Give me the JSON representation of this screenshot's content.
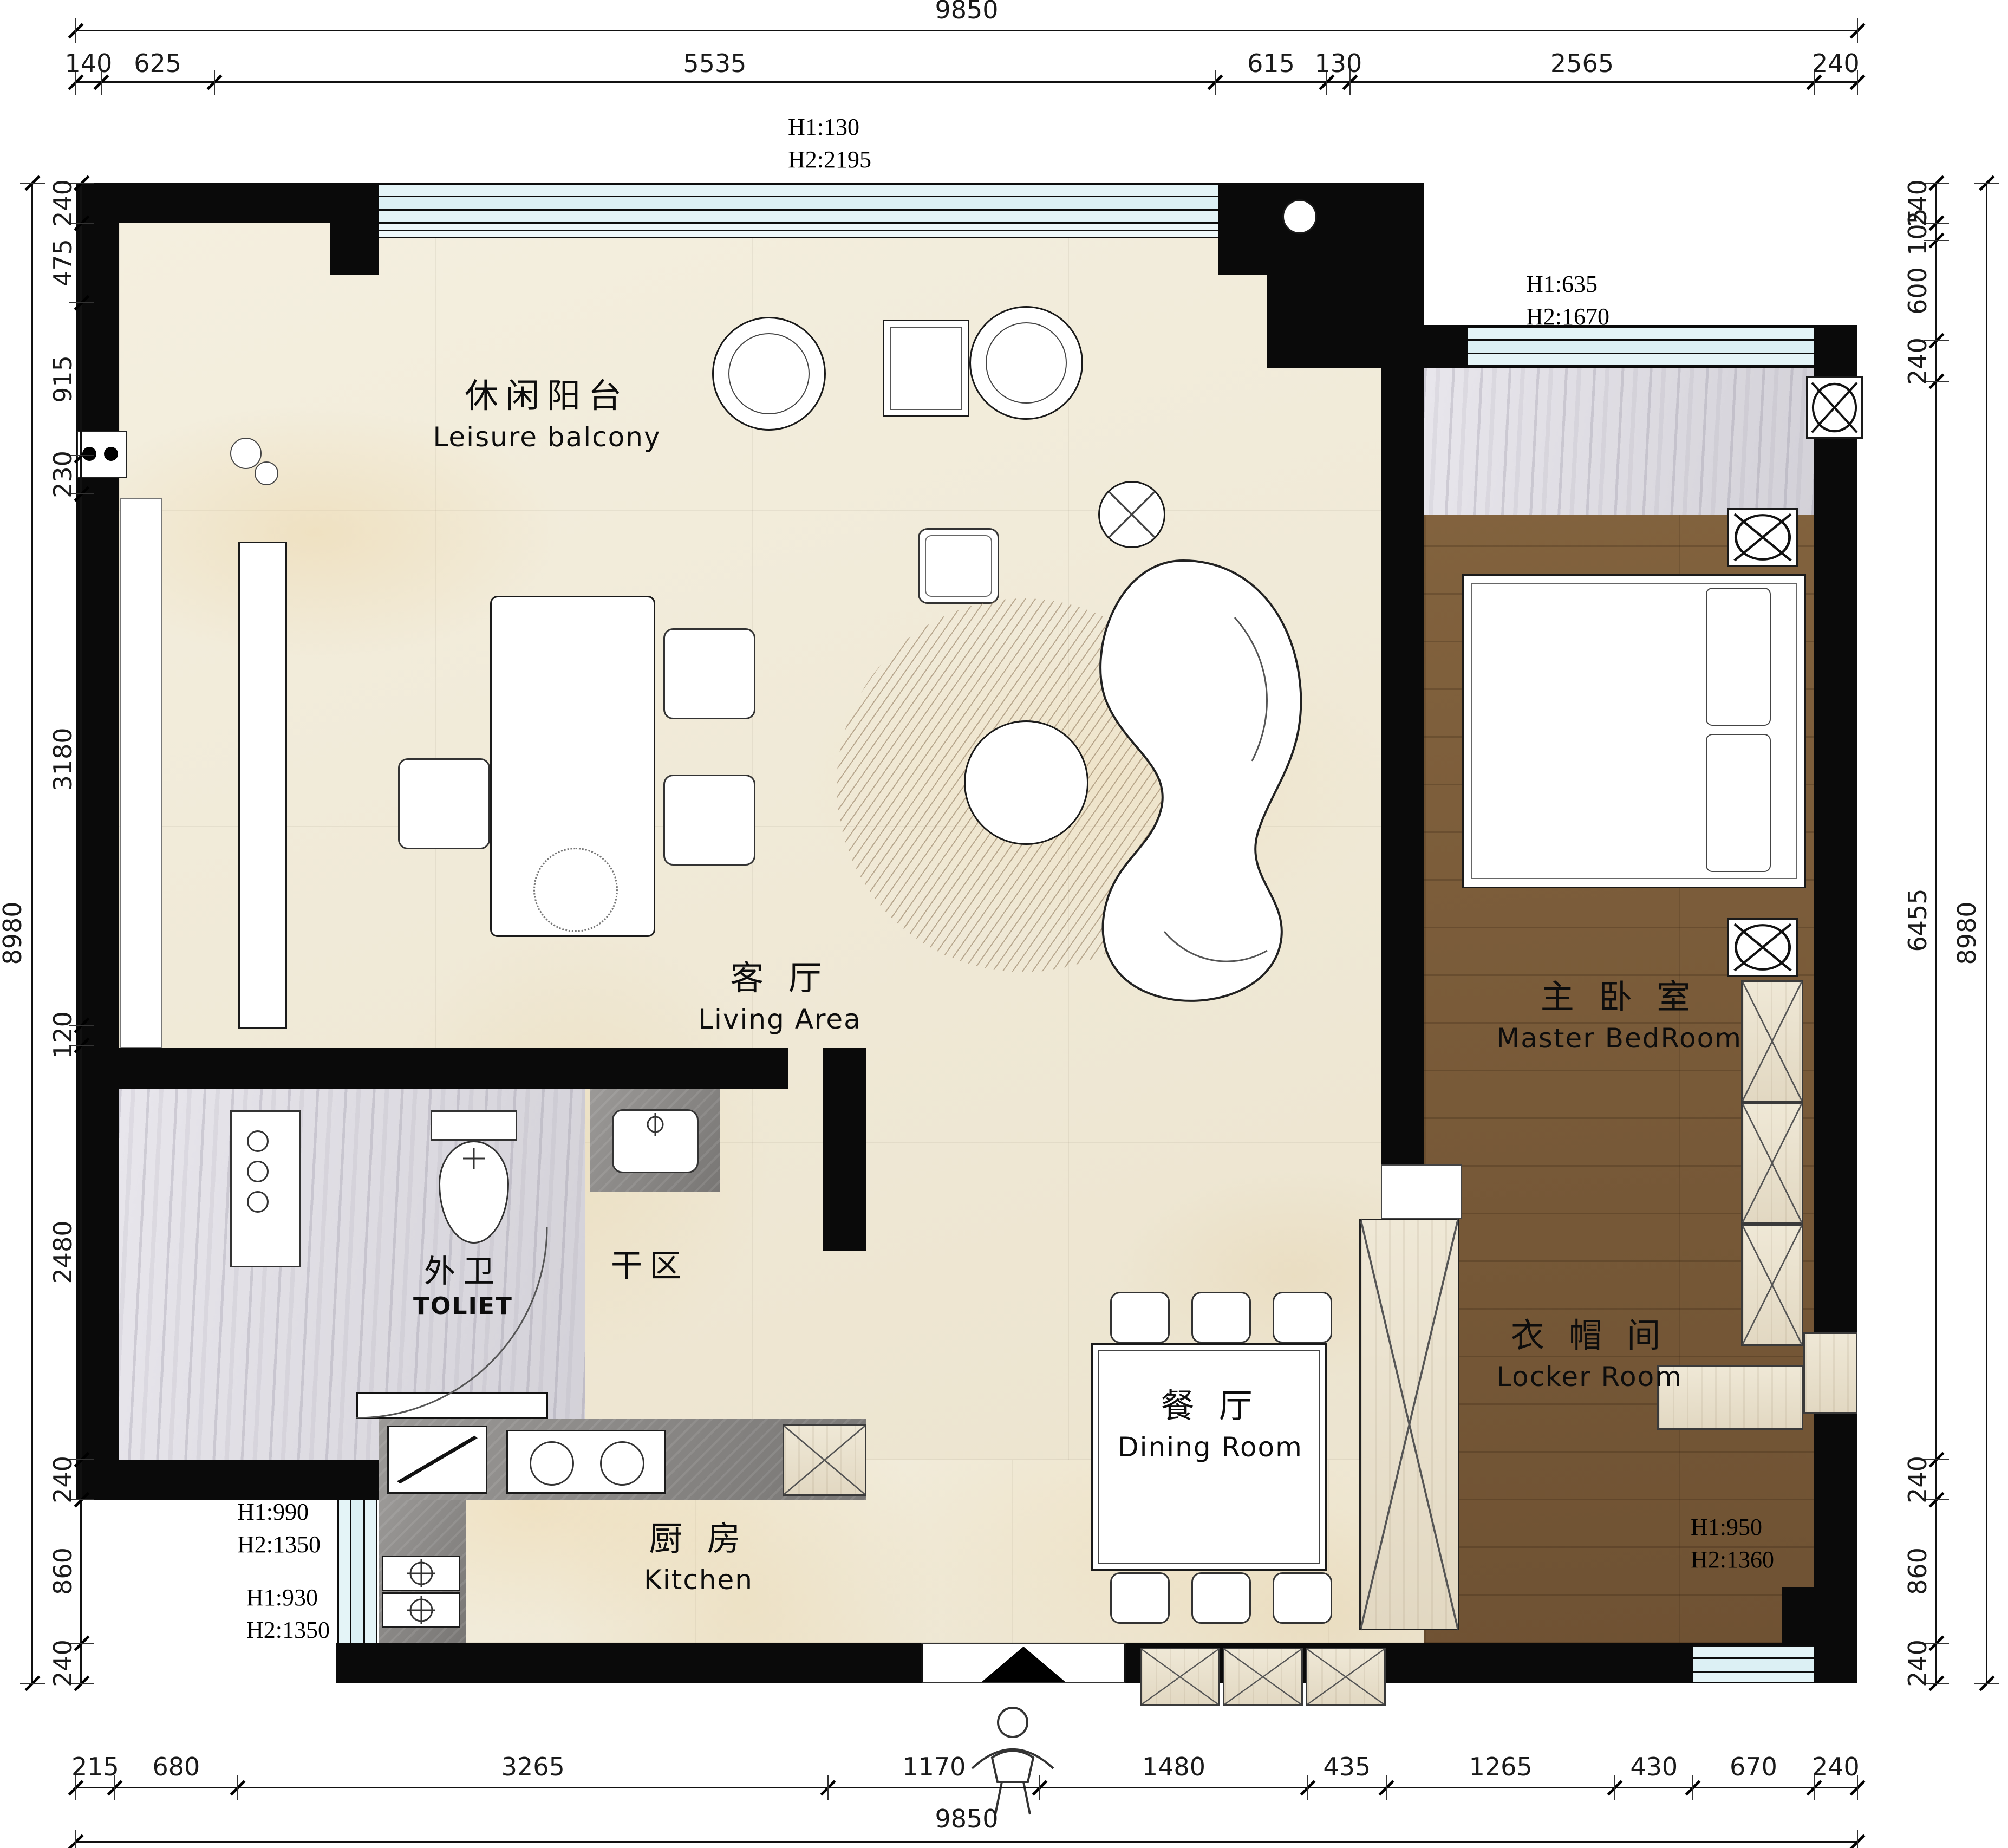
{
  "drawing_type": "apartment floor plan",
  "rooms": {
    "leisure_balcony": {
      "zh": "休闲阳台",
      "en": "Leisure balcony"
    },
    "living": {
      "zh": "客 厅",
      "en": "Living Area"
    },
    "master_bedroom": {
      "zh": "主 卧 室",
      "en": "Master BedRoom"
    },
    "toilet": {
      "zh": "外卫",
      "en": "TOLIET"
    },
    "dry_area": {
      "zh": "干区",
      "en": ""
    },
    "dining": {
      "zh": "餐 厅",
      "en": "Dining Room"
    },
    "kitchen": {
      "zh": "厨 房",
      "en": "Kitchen"
    },
    "locker": {
      "zh": "衣 帽 间",
      "en": "Locker Room"
    }
  },
  "dimensions": {
    "top": {
      "total": 9850,
      "segments": [
        140,
        625,
        5535,
        615,
        130,
        2565,
        240
      ]
    },
    "bottom": {
      "total": 9850,
      "segments": [
        215,
        680,
        3265,
        1170,
        1480,
        435,
        1265,
        430,
        670,
        240
      ]
    },
    "left": {
      "total": 8980,
      "segments": [
        240,
        475,
        915,
        230,
        3180,
        120,
        2480,
        240,
        860,
        240
      ]
    },
    "right": {
      "total": 8980,
      "segments": [
        240,
        105,
        600,
        240,
        6455,
        240,
        860,
        240
      ]
    }
  },
  "annotations": {
    "top_window": {
      "h1": "H1:130",
      "h2": "H2:2195"
    },
    "bedroom_window": {
      "h1": "H1:635",
      "h2": "H2:1670"
    },
    "left_window_upper": {
      "h1": "H1:990",
      "h2": "H2:1350"
    },
    "left_window_lower": {
      "h1": "H1:930",
      "h2": "H2:1350"
    },
    "bottom_right_window": {
      "h1": "H1:950",
      "h2": "H2:1360"
    }
  },
  "colors": {
    "wall": "#0a0a0a",
    "window_glass": "#dff1f5",
    "floor_marble_cream": "#f0e9d7",
    "floor_marble_grey": "#dcdae0",
    "floor_wood": "#7b5b39",
    "cabinet_light_wood": "#eae1cd",
    "counter_grey": "#8e8c8a",
    "dimension_line": "#1a1a1a"
  }
}
